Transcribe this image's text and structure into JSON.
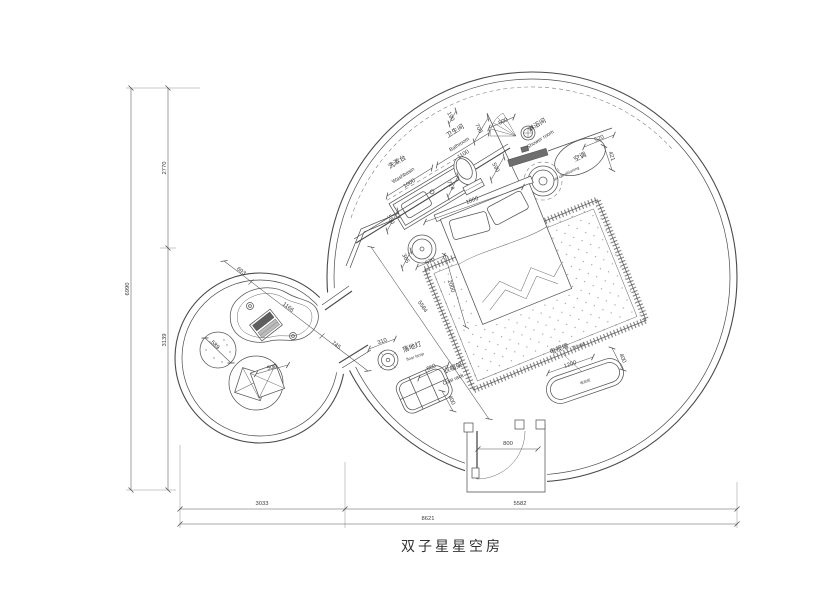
{
  "title": "双子星星空房",
  "labels": {
    "washbasin_cn": "洗漱台",
    "washbasin_en": "Washbasin",
    "bathroom_cn": "卫生间",
    "bathroom_en": "Bathroom",
    "shower_cn": "淋浴间",
    "shower_en": "Shower room",
    "ac_cn": "空调",
    "ac_en": "air conditioning",
    "floor_lamp_cn": "落地灯",
    "floor_lamp_en": "floor lamp",
    "coat_rack_cn": "衣帽架",
    "coat_rack_en": "Coat rack",
    "tv_wall_cn": "电视墙",
    "tv_wall_en": "TV wall",
    "tv_cabinet_cn": "电视柜"
  },
  "dims": {
    "height_total": "6990",
    "height_top": "2770",
    "height_bottom": "3139",
    "width_left": "3033",
    "width_right": "5582",
    "width_total": "8621",
    "entry_door": "800",
    "bed_width": "1800",
    "bed_length": "2000",
    "nightstand_offset": "365",
    "nightstand_width": "570",
    "room_diagonal": "5584",
    "corridor_width": "745",
    "lounge_a": "693",
    "lounge_b": "1166",
    "ottoman": "589",
    "cushion": "500",
    "floor_lamp": "310",
    "coat_rack_w": "660",
    "coat_rack_d": "400",
    "tv_w": "1200",
    "tv_d": "400",
    "washbasin_w": "1000",
    "washbasin_d": "550",
    "bathroom_w": "1100",
    "bath_gap": "190",
    "bath_door": "700",
    "toilet_w": "714",
    "shower_door": "500",
    "shower_w": "590",
    "ac_w": "520",
    "ac_d": "421"
  }
}
